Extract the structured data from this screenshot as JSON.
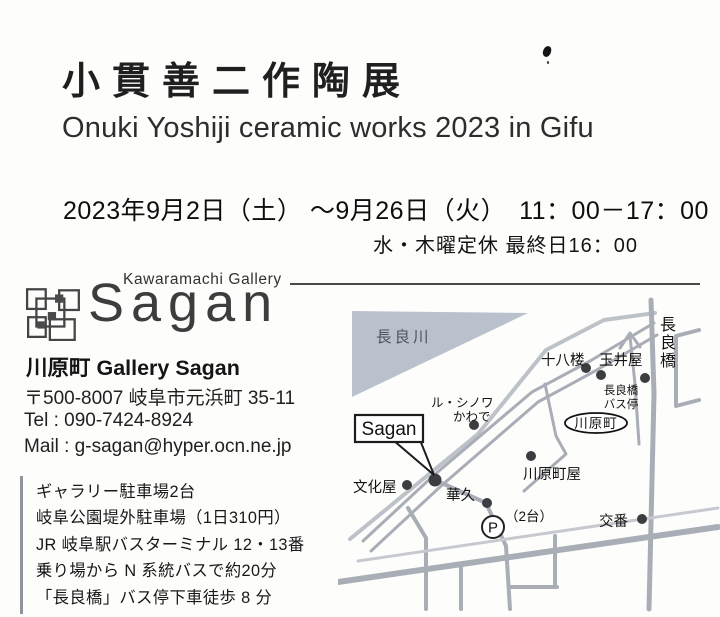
{
  "header": {
    "title_jp": "小貫善二作陶展",
    "title_en": "Onuki Yoshiji ceramic works 2023 in Gifu",
    "date_line": "2023年9月2日（土） ～9月26日（火）　11：00－17：00",
    "closed_note": "水・木曜定休 最終日16：00"
  },
  "logo": {
    "gallery_small": "Kawaramachi Gallery",
    "gallery_script": "Sagan"
  },
  "contact": {
    "name": "川原町 Gallery Sagan",
    "address": "〒500-8007 岐阜市元浜町 35-11",
    "tel": "Tel : 090-7424-8924",
    "mail": "Mail : g-sagan@hyper.ocn.ne.jp"
  },
  "access": {
    "lines": [
      "ギャラリー駐車場2台",
      "岐阜公園堤外駐車場（1日310円）",
      "JR 岐阜駅バスターミナル 12・13番",
      "乗り場から N 系統バスで約20分",
      "「長良橋」バス停下車徒歩 8 分"
    ]
  },
  "map": {
    "river": "長良川",
    "juhachiro": "十八楼",
    "tamaiya": "玉井屋",
    "busstop_line1": "長良橋",
    "busstop_line2": "バス停",
    "bridge_chars": [
      "長",
      "良",
      "橋"
    ],
    "le_chinois_line1": "ル・シノワ",
    "le_chinois_line2": "かわで",
    "sagan_label": "Sagan",
    "kawaramachi_oval": "川原町",
    "bunkaya": "文化屋",
    "hanakyu": "華久",
    "kawaramachiya": "川原町屋",
    "parking_p": "P",
    "parking_count": "（2台）",
    "koban": "交番",
    "colors": {
      "road": "#a9aeb6",
      "road_light": "#c6c9cf",
      "river": "#bac1cc",
      "dot": "#3b3d41",
      "text": "#121212"
    }
  }
}
